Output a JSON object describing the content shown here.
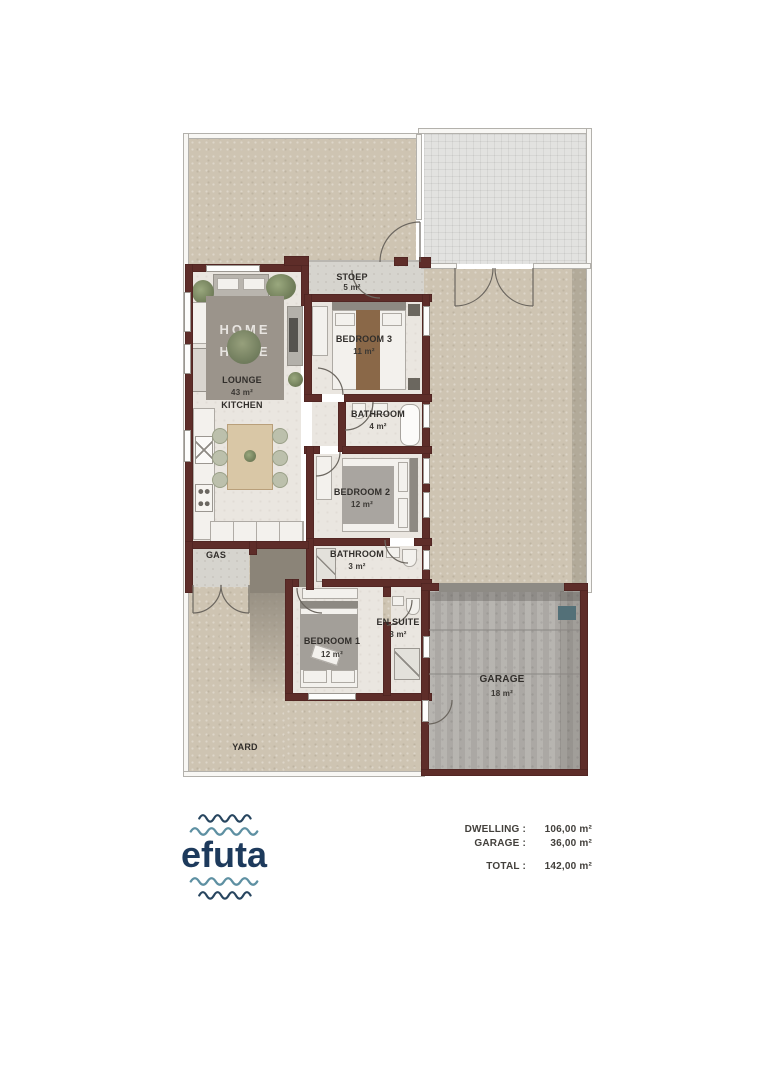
{
  "plan": {
    "rooms": {
      "stoep": {
        "label": "STOEP",
        "area": "5 m²"
      },
      "bedroom3": {
        "label": "BEDROOM 3",
        "area": "11 m²"
      },
      "lounge": {
        "label": "LOUNGE",
        "area": "43 m²"
      },
      "kitchen": {
        "label": "KITCHEN"
      },
      "bathroom_main": {
        "label": "BATHROOM",
        "area": "4 m²"
      },
      "bedroom2": {
        "label": "BEDROOM 2",
        "area": "12 m²"
      },
      "bathroom_small": {
        "label": "BATHROOM",
        "area": "3 m²"
      },
      "gas": {
        "label": "GAS"
      },
      "ensuite": {
        "label": "EN SUITE",
        "area": "3 m²"
      },
      "bedroom1": {
        "label": "BEDROOM 1",
        "area": "12 m²"
      },
      "garage": {
        "label": "GARAGE",
        "area": "18 m²"
      },
      "yard": {
        "label": "YARD"
      }
    },
    "rug_text": {
      "line1": "HOME",
      "line2": "HOME"
    }
  },
  "logo": {
    "text": "efuta"
  },
  "area_schedule": {
    "dwelling": {
      "label": "DWELLING :",
      "value": "106,00 m²"
    },
    "garage": {
      "label": "GARAGE :",
      "value": "36,00 m²"
    },
    "total": {
      "label": "TOTAL :",
      "value": "142,00 m²"
    }
  },
  "colors": {
    "wall": "#5e2d29",
    "yard": "#cec4b2",
    "paving": "#e2e2e0",
    "garage_floor": "#b3b0ab",
    "logo_navy": "#1d3a5c",
    "logo_teal": "#5e90a2"
  }
}
